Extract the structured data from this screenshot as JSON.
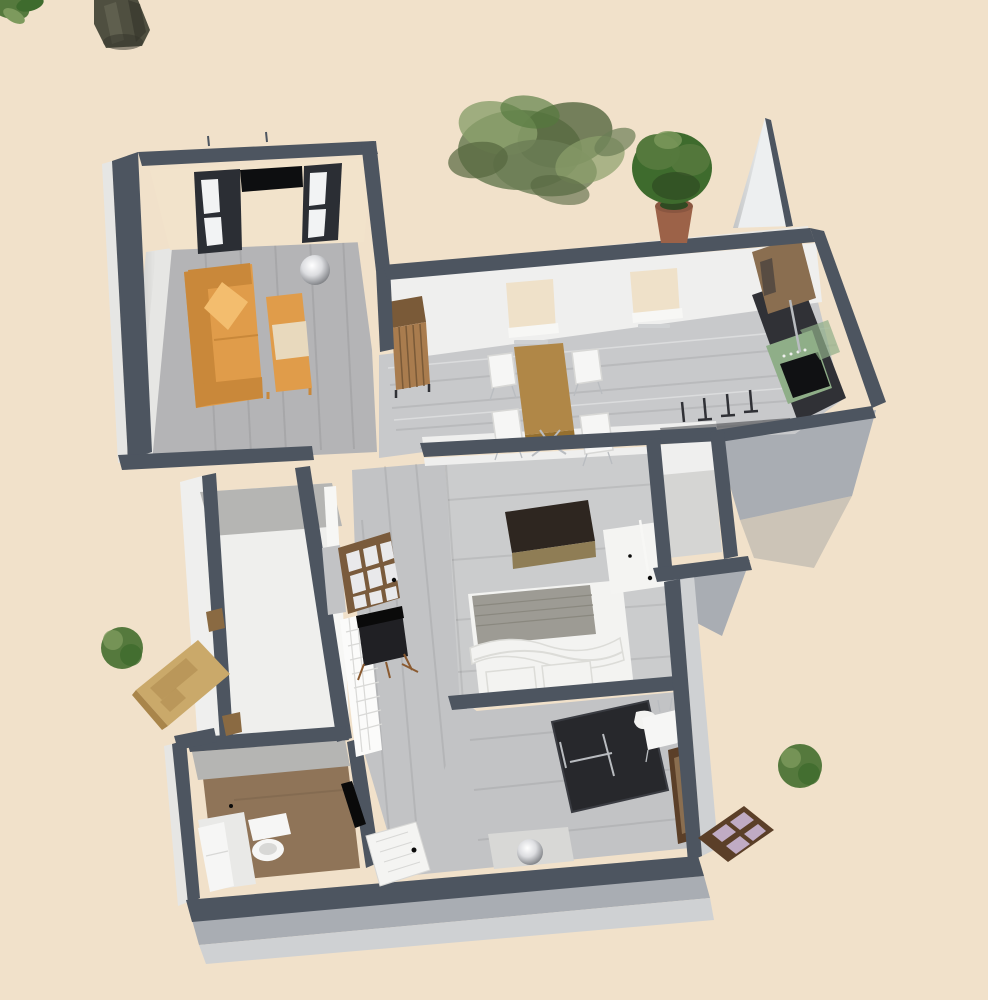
{
  "viewport": {
    "kind": "home-design-3d-aerial-view",
    "width": 988,
    "height": 1000
  },
  "palette": {
    "ground": "#f1e1ca",
    "ground_shadow": "#a9adb3",
    "ground_shadow_soft": "rgba(120,128,138,0.30)",
    "wall_top": "#4d5560",
    "wall_face_light": "#cfd1d3",
    "wall_face_lighter": "#e6e6e4",
    "wall_face_white": "#efefee",
    "wall_face_bright": "#f7f7f5",
    "wall_face_shadow": "#a9adb3",
    "wall_face_midgray": "#b5b5b3",
    "wall_ext_strip": "#eae8e4",
    "wall_inner_cream": "#f2e3cb",
    "cream_window": "#efe1c9",
    "window_frame_dark": "#2b2e34",
    "window_pane_white": "#f2f3f4",
    "floor_living": "#b4b4b6",
    "floor_dining": "#c8c9cb",
    "floor_bedroom": "#cbcccd",
    "floor_hall": "#c2c3c5",
    "floor_alcove": "#d5d5d3",
    "floor_vestibule": "#efefed",
    "floor_wc_wood": "#8f7458",
    "floor_wc_tile": "#e9e9e7",
    "plank_dark": "rgba(0,0,0,0.07)",
    "plank_light": "rgba(255,255,255,0.35)",
    "sofa": "#e09c4a",
    "sofa_dark": "#c9883a",
    "pillow": "#f3bd6e",
    "bench_mid": "#e8d9bd",
    "tv_black": "#0d0e10",
    "wood_table": "#b08747",
    "wood_table_edge": "#96702f",
    "wood_cabinet": "#a97c4e",
    "wood_cabinet_top": "#7a5a38",
    "chair_white": "#f6f6f5",
    "chair_white_line": "#d8d8d6",
    "counter_dark": "#303136",
    "stove_green": "#8fae88",
    "oven_black": "#101113",
    "door_kitchen_brown": "#8a6e50",
    "door_tan": "#caa96a",
    "door_tan_dark": "#a9854a",
    "door_frame_brown": "#8a6a42",
    "glass_door_frame": "#7a5b3c",
    "glass_door_pane": "#e9e9eb",
    "door_white": "#f4f4f2",
    "chair_dark": "#202024",
    "chair_leg_brown": "#8a5a30",
    "radiator_white": "#fbfbfa",
    "radiator_line": "#d9d9d7",
    "tub_dark": "#27282c",
    "tub_edge": "#3a3c42",
    "chrome": "#b9bcc0",
    "bed_white": "#f3f3f1",
    "bed_fold": "#dcdcd8",
    "bed_blanket": "#9d9b94",
    "bed_blanket_line": "#8a887f",
    "bed_leg_tan": "#b2895a",
    "dresser_dark": "#2e2620",
    "dresser_base": "#8f7d55",
    "black_detail": "#0a0a0a",
    "mat_light": "#d8d8d6",
    "trunk": "#4f4f40",
    "trunk_light": "#6a6a58",
    "trunk_dark": "#33332a",
    "tree_dark": "#3e6b2d",
    "tree_mid": "#55793d",
    "tree_light": "#7d9a5d",
    "bush_olive": "#6b7d55",
    "bush_olive_light": "#8ba06b",
    "bush_olive_dark": "#55663f",
    "pot_terracotta": "#9c6248",
    "pot_rim": "#8a5640",
    "soil_green": "#2f4a22",
    "skylight_frame": "#5b3f28",
    "skylight_pane": "#c0abc4",
    "gable_white": "#edeff0"
  },
  "rooms": [
    {
      "id": "living-room",
      "floor": "gray plank"
    },
    {
      "id": "dining-area",
      "floor": "light gray plank"
    },
    {
      "id": "kitchen",
      "floor": "light gray plank"
    },
    {
      "id": "hallway",
      "floor": "gray plank"
    },
    {
      "id": "vestibule",
      "floor": "white"
    },
    {
      "id": "storage-nook",
      "floor": "gray"
    },
    {
      "id": "bedroom",
      "floor": "light gray plank"
    },
    {
      "id": "bathroom",
      "floor": "gray plank"
    },
    {
      "id": "wc",
      "floor": "brown wood"
    }
  ],
  "furniture": [
    "sofa",
    "coffee-bench",
    "ceiling-lamp-sphere",
    "tv",
    "living-window-left",
    "living-window-right",
    "wardrobe",
    "dining-table",
    "dining-chairs",
    "dining-window-left",
    "dining-window-right",
    "kitchen-counter",
    "stove",
    "kitchen-door",
    "bar-stools",
    "glass-door",
    "hall-chair",
    "radiator",
    "entrance-door",
    "bed",
    "dresser",
    "bedroom-door",
    "storage-door",
    "bathtub",
    "bathroom-sink",
    "bathroom-door",
    "bathroom-window",
    "bath-stool-sphere",
    "toilet",
    "wc-cabinet"
  ],
  "outdoor_items": [
    "tree-trunk",
    "corner-foliage",
    "large-shrub",
    "potted-plant",
    "small-bush-left",
    "small-bush-right",
    "skylight-on-ground",
    "gable-wall"
  ]
}
